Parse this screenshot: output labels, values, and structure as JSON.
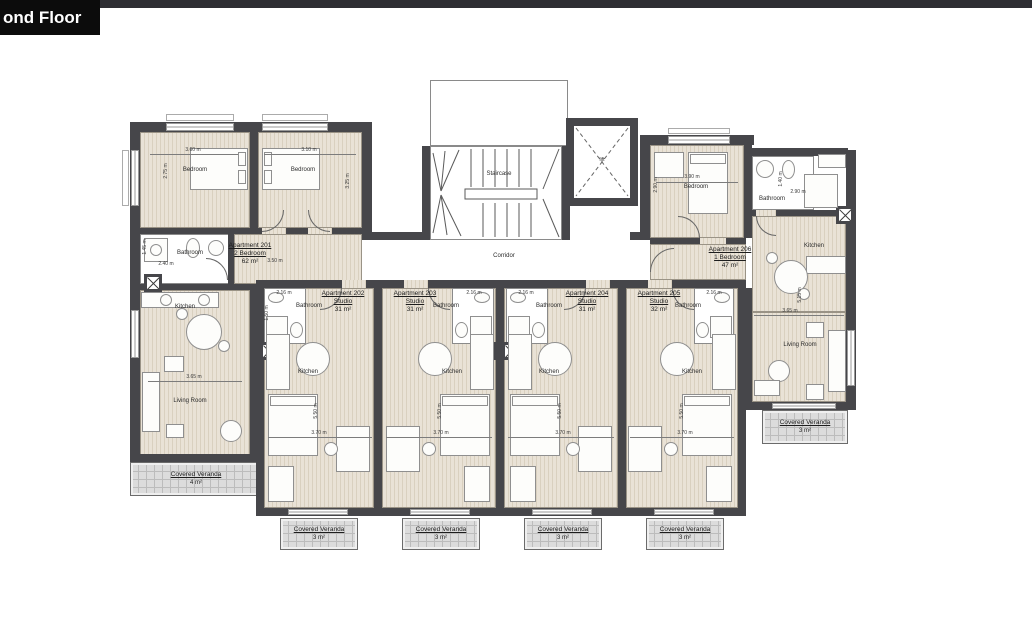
{
  "header": {
    "title": "ond Floor"
  },
  "core": {
    "staircase": "Staircase",
    "corridor": "Corridor",
    "lift": "lift"
  },
  "rooms": {
    "bedroom": "Bedroom",
    "bathroom": "Bathroom",
    "kitchen": "Kitchen",
    "living_room": "Living Room"
  },
  "apartments": [
    {
      "name": "Apartment 201",
      "type": "2 Bedroom",
      "area": "62 m²"
    },
    {
      "name": "Apartment 202",
      "type": "Studio",
      "area": "31 m²"
    },
    {
      "name": "Apartment 203",
      "type": "Studio",
      "area": "31 m²"
    },
    {
      "name": "Apartment 204",
      "type": "Studio",
      "area": "31 m²"
    },
    {
      "name": "Apartment 205",
      "type": "Studio",
      "area": "32 m²"
    },
    {
      "name": "Apartment 206",
      "type": "1 Bedroom",
      "area": "47 m²"
    }
  ],
  "verandas": {
    "title": "Covered Veranda",
    "areas": [
      "4 m²",
      "3 m²",
      "3 m²",
      "3 m²",
      "3 m²",
      "3 m²"
    ]
  },
  "dimensions": {
    "bedroom1_w": "3.60 m",
    "bedroom1_h": "2.75 m",
    "bedroom2_w": "3.10 m",
    "bedroom2_h": "3.25 m",
    "bath201_w": "2.40 m",
    "bath201_h": "1.45 m",
    "hall201_w": "3.50 m",
    "living201_w": "3.65 m",
    "studio_w": "3.70 m",
    "studio_h": "5.50 m",
    "studio_bath_w": "2.16 m",
    "studio_bath_h": "1.50 m",
    "bedroom206_w": "3.90 m",
    "bedroom206_h": "2.90 m",
    "bath206_w": "2.90 m",
    "bath206_h": "1.40 m",
    "living206_w": "3.65 m",
    "living206_h": "5.15 m"
  },
  "colors": {
    "wall": "#46464a",
    "floor": "#e7e0d3",
    "veranda": "#dcdcdc",
    "accent_bar": "#2e2e33"
  }
}
